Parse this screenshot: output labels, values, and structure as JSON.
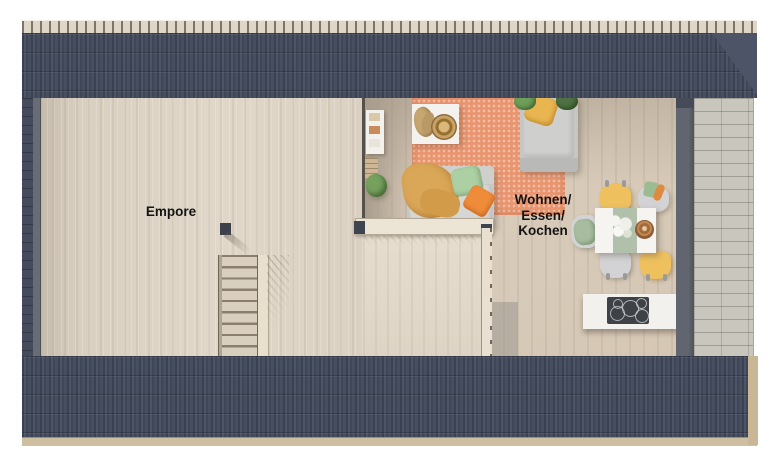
{
  "floorplan": {
    "rooms": [
      {
        "id": "empore",
        "label": "Empore"
      },
      {
        "id": "wohnen-essen-kochen",
        "label": "Wohnen/Essen/Kochen",
        "label_lines": [
          "Wohnen/",
          "Essen/",
          "Kochen"
        ]
      }
    ],
    "features": [
      "roof-top",
      "roof-bottom",
      "left-gable",
      "terrace",
      "staircase",
      "half-wall",
      "partition-wall"
    ],
    "furniture": [
      "wall-shelf",
      "coffee-table",
      "rug",
      "sofa",
      "daybed",
      "dining-table",
      "dining-chairs",
      "kitchen-counter",
      "cooktop",
      "plants"
    ],
    "colors": {
      "roof": "#454c5e",
      "roof_ridge": "#ded7c7",
      "empore_floor": "#ddd3c5",
      "living_floor": "#d6c9b7",
      "terrace_tile": "#c9c6bd",
      "rug": "#e9956f",
      "sofa_gray": "#c8c8c6",
      "accent_yellow": "#eec05e",
      "accent_orange": "#ef8c3a",
      "accent_green": "#accfa3",
      "wall_dark": "#5c616b",
      "label_text": "#141414"
    }
  }
}
